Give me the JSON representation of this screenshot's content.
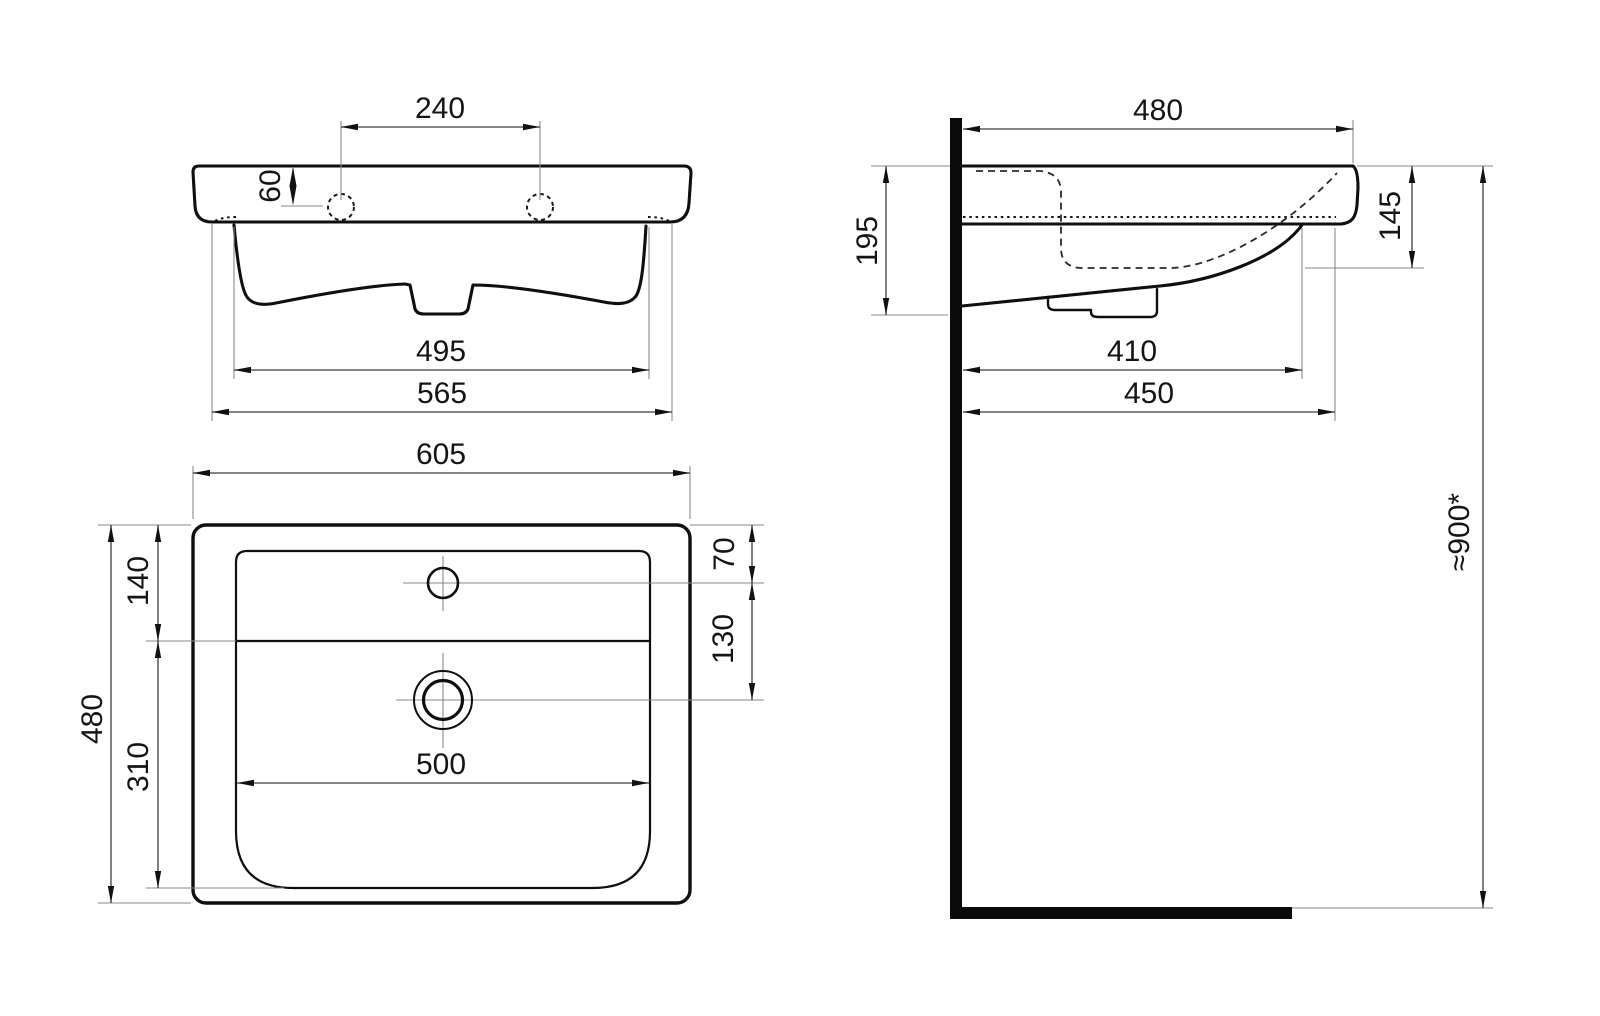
{
  "drawing": {
    "kind": "washbasin-installation-technical-drawing",
    "views": [
      "front-view",
      "side-section-view",
      "top-plan-view"
    ],
    "colors": {
      "background": "#ffffff",
      "outline": "#0f0f0f",
      "dimension_line": "#3c3c3c",
      "extension_line": "#8a8a8a",
      "text": "#141414"
    },
    "front": {
      "tap_hole_spacing": "240",
      "tap_hole_offset": "60",
      "bowl_width": "495",
      "hidden_body_width": "565"
    },
    "side": {
      "overall_depth": "480",
      "height_at_wall": "195",
      "basin_inner_depth": "145",
      "trap_cover_depth": "410",
      "underside_depth": "450",
      "mounting_height": "≈900*"
    },
    "plan": {
      "overall_width": "605",
      "overall_depth": "480",
      "deck_depth": "140",
      "bowl_depth": "310",
      "tap_hole_from_back": "70",
      "tap_hole_to_drain": "130",
      "bowl_width": "500"
    }
  }
}
